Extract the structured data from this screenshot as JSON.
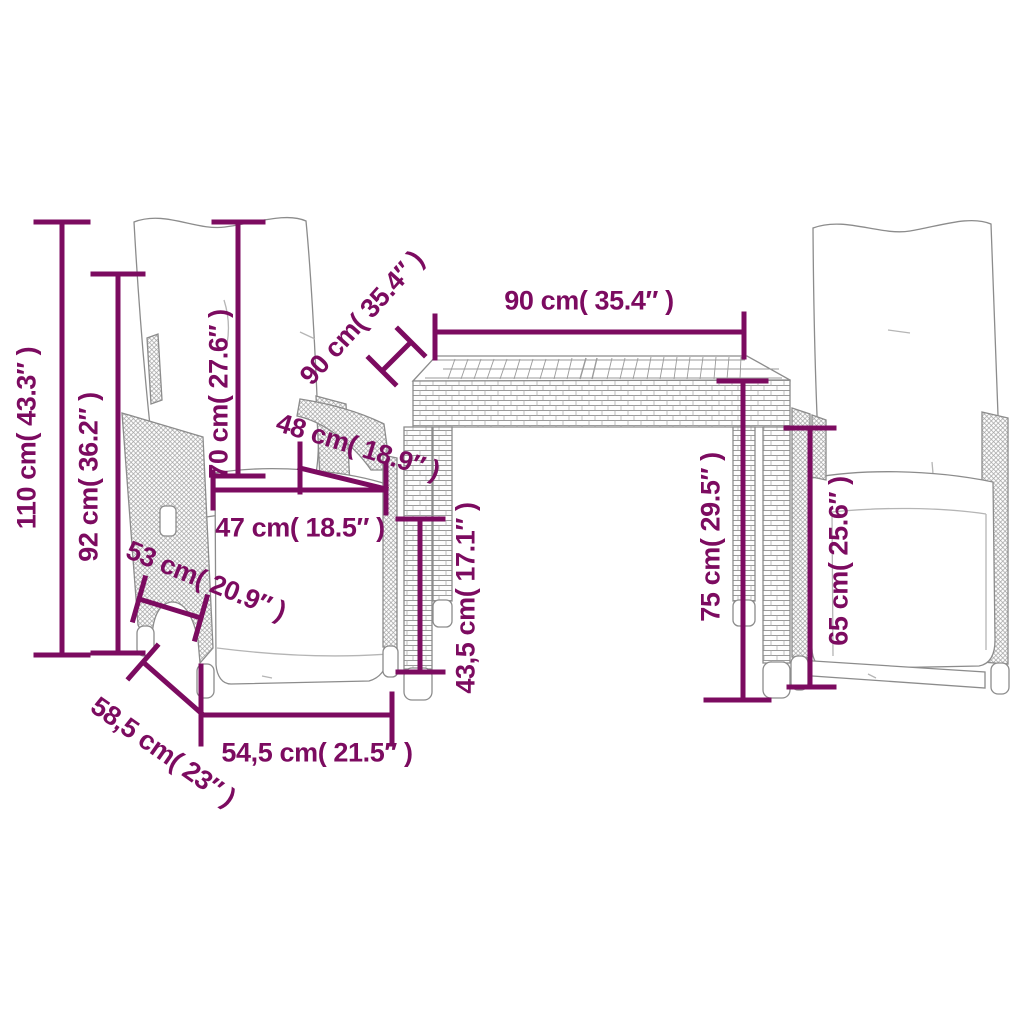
{
  "diagram": {
    "kind": "furniture dimension diagram",
    "scene": "two reclining garden chairs with back cushions and a slatted-top rattan table",
    "colors": {
      "dimension_lines": "#7C0B60",
      "furniture_outline": "#8C8C8C",
      "background": "#FFFFFF"
    }
  },
  "labels": {
    "d110": "110 cm( 43.3″ )",
    "d92": "92 cm( 36.2″ )",
    "d70": "70 cm( 27.6″ )",
    "d90_diagonal": "90 cm( 35.4″ )",
    "d90_top": "90 cm( 35.4″ )",
    "d48": "48 cm( 18.9″ )",
    "d47": "47 cm( 18.5″ )",
    "d53": "53 cm( 20.9″ )",
    "d43_5": "43,5 cm( 17.1″ )",
    "d75": "75 cm( 29.5″ )",
    "d65": "65 cm( 25.6″ )",
    "d58_5": "58,5 cm( 23″ )",
    "d54_5": "54,5 cm( 21.5″ )"
  }
}
